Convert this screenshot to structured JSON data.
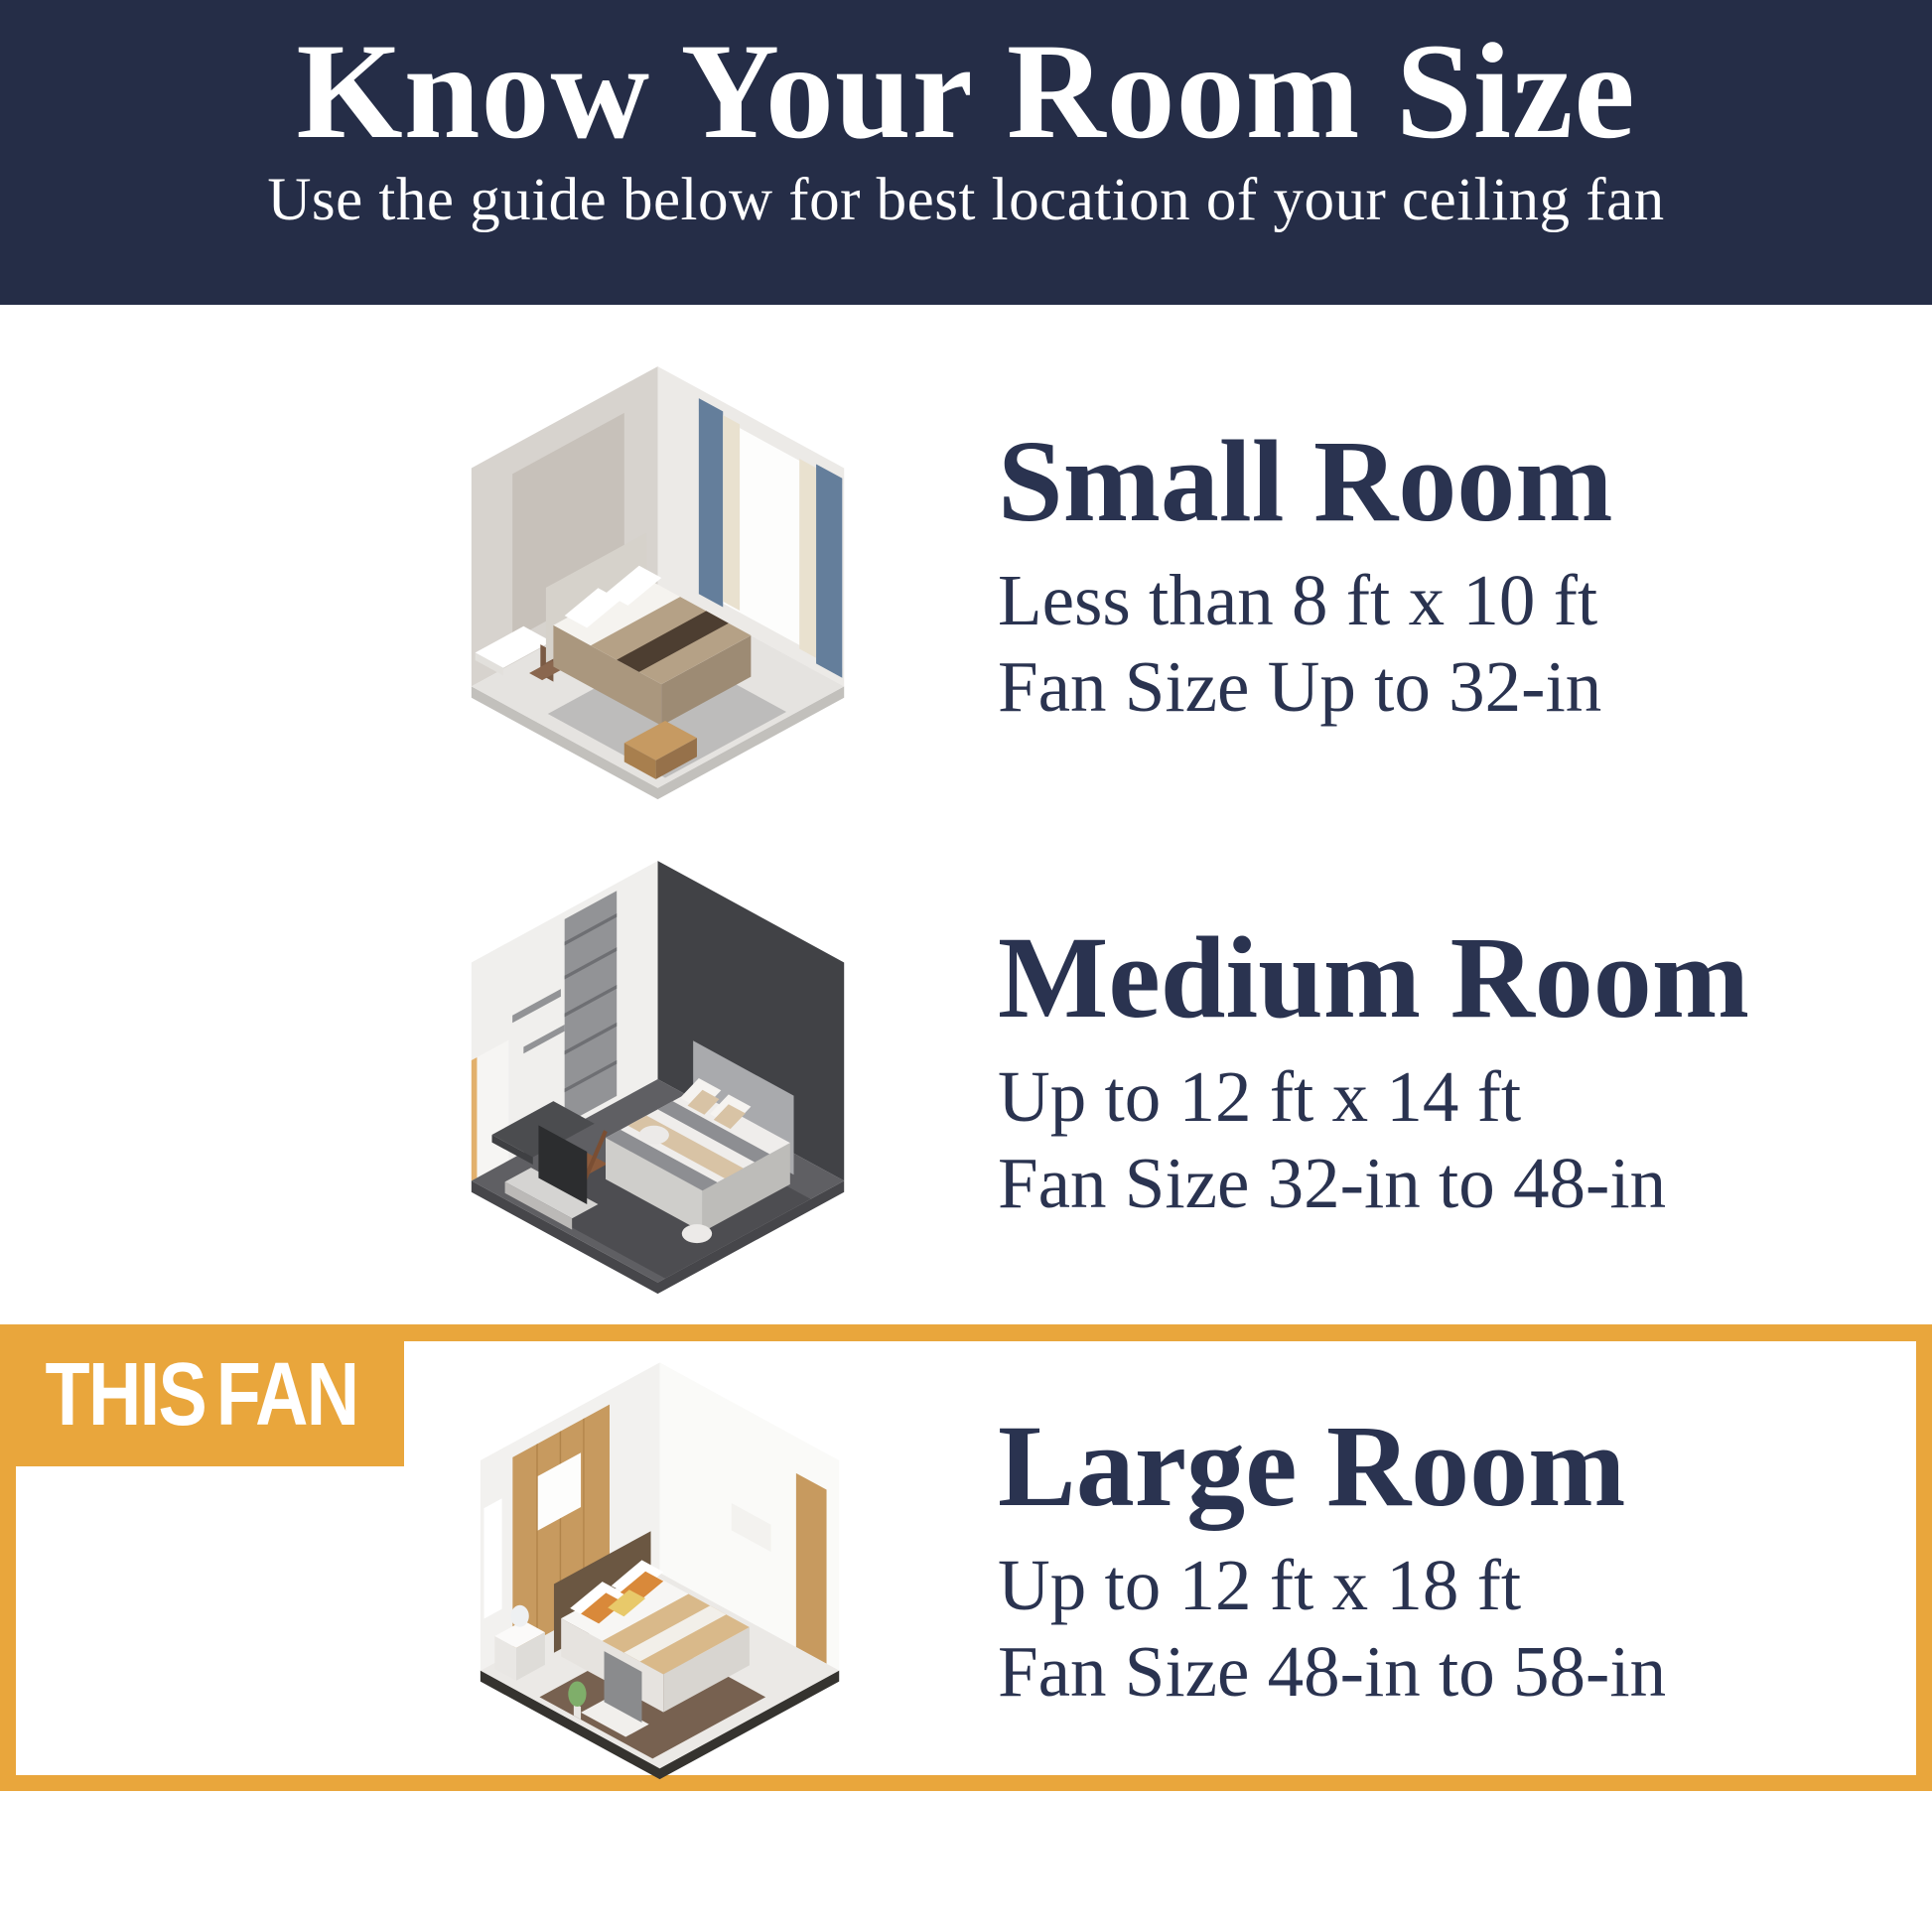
{
  "colors": {
    "header_background": "#252D47",
    "header_text": "#FFFFFF",
    "body_text": "#2A3350",
    "highlight_orange": "#E9A63C",
    "highlight_label_text": "#FFFFFF",
    "page_background": "#FFFFFF"
  },
  "header": {
    "title": "Know Your Room Size",
    "subtitle": "Use the guide below for best location of your ceiling fan"
  },
  "sections": [
    {
      "id": "small-room",
      "title": "Small Room",
      "dimensions": "Less than 8 ft x 10 ft",
      "fan_size": "Fan Size Up to 32-in",
      "illustration": "small-bedroom-isometric-illustration",
      "highlighted": false
    },
    {
      "id": "medium-room",
      "title": "Medium Room",
      "dimensions": "Up to 12 ft x 14 ft",
      "fan_size": "Fan Size 32-in to 48-in",
      "illustration": "medium-bedroom-isometric-illustration",
      "highlighted": false
    },
    {
      "id": "large-room",
      "title": "Large Room",
      "dimensions": "Up to 12 ft x 18 ft",
      "fan_size": "Fan Size 48-in to 58-in",
      "illustration": "large-bedroom-isometric-illustration",
      "highlighted": true,
      "highlight_label": "THIS FAN"
    }
  ]
}
